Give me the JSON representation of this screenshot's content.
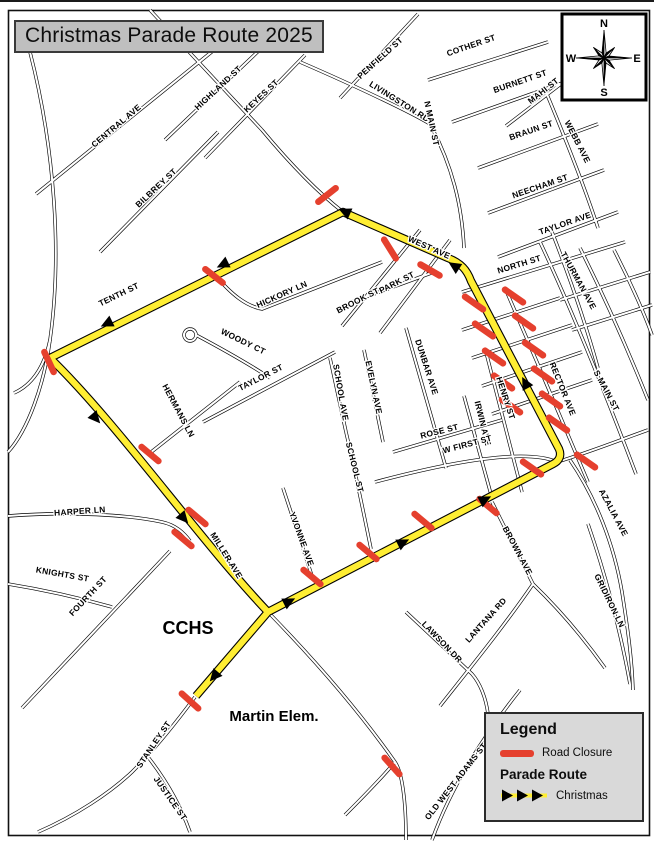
{
  "title": "Christmas Parade Route 2025",
  "compass": {
    "n": "N",
    "e": "E",
    "s": "S",
    "w": "W"
  },
  "legend": {
    "heading": "Legend",
    "road_closure_label": "Road Closure",
    "parade_route_heading": "Parade Route",
    "christmas_label": "Christmas"
  },
  "colors": {
    "route_yellow": "#ffee33",
    "closure_red": "#e5402e",
    "road_black": "#000000",
    "legend_bg": "#d9d9d9",
    "title_bg": "#bfbfbf"
  },
  "places": [
    {
      "label": "CCHS",
      "x": 188,
      "y": 634,
      "s": 18
    },
    {
      "label": "Martin Elem.",
      "x": 274,
      "y": 721,
      "s": 15
    }
  ],
  "streets": [
    {
      "name": "CENTRAL AVE",
      "x": 118,
      "y": 128,
      "r": -40
    },
    {
      "name": "HIGHLAND ST",
      "x": 220,
      "y": 90,
      "r": -43
    },
    {
      "name": "KEYES ST",
      "x": 263,
      "y": 98,
      "r": -43
    },
    {
      "name": "BILBREY ST",
      "x": 158,
      "y": 190,
      "r": -43
    },
    {
      "name": "PENFIELD ST",
      "x": 382,
      "y": 60,
      "r": -42
    },
    {
      "name": "LIVINGSTON RD",
      "x": 398,
      "y": 104,
      "r": 32
    },
    {
      "name": "COTHER ST",
      "x": 472,
      "y": 48,
      "r": -19
    },
    {
      "name": "BURNETT ST",
      "x": 521,
      "y": 84,
      "r": -19
    },
    {
      "name": "N MAIN ST",
      "x": 429,
      "y": 124,
      "r": 78
    },
    {
      "name": "MAHI ST",
      "x": 545,
      "y": 93,
      "r": -38
    },
    {
      "name": "BRAUN ST",
      "x": 532,
      "y": 133,
      "r": -19
    },
    {
      "name": "WEBB AVE",
      "x": 575,
      "y": 143,
      "r": 63
    },
    {
      "name": "NEECHAM ST",
      "x": 541,
      "y": 189,
      "r": -19
    },
    {
      "name": "TAYLOR AVE",
      "x": 566,
      "y": 226,
      "r": -19
    },
    {
      "name": "NORTH ST",
      "x": 520,
      "y": 267,
      "r": -17
    },
    {
      "name": "THURMAN AVE",
      "x": 576,
      "y": 282,
      "r": 61
    },
    {
      "name": "WEST AVE",
      "x": 428,
      "y": 250,
      "r": 24
    },
    {
      "name": "TENTH ST",
      "x": 120,
      "y": 297,
      "r": -26
    },
    {
      "name": "HICKORY LN",
      "x": 283,
      "y": 297,
      "r": -24
    },
    {
      "name": "PARK ST",
      "x": 398,
      "y": 285,
      "r": -27
    },
    {
      "name": "BROOK ST",
      "x": 359,
      "y": 303,
      "r": -27
    },
    {
      "name": "WOODY CT",
      "x": 242,
      "y": 344,
      "r": 26
    },
    {
      "name": "TAYLOR ST",
      "x": 262,
      "y": 380,
      "r": -27
    },
    {
      "name": "SCHOOL AVE",
      "x": 338,
      "y": 393,
      "r": 80
    },
    {
      "name": "EVELYN AVE",
      "x": 371,
      "y": 388,
      "r": 78
    },
    {
      "name": "DUNBAR AVE",
      "x": 424,
      "y": 368,
      "r": 72
    },
    {
      "name": "RECTOR AVE",
      "x": 560,
      "y": 390,
      "r": 68
    },
    {
      "name": "S MAIN ST",
      "x": 604,
      "y": 392,
      "r": 62
    },
    {
      "name": "HERMANS LN",
      "x": 176,
      "y": 412,
      "r": 62
    },
    {
      "name": "HENRY ST",
      "x": 503,
      "y": 399,
      "r": 72
    },
    {
      "name": "IRWIN AVE",
      "x": 480,
      "y": 424,
      "r": 76
    },
    {
      "name": "ROSE ST",
      "x": 440,
      "y": 434,
      "r": -14
    },
    {
      "name": "SCHOOL ST",
      "x": 352,
      "y": 468,
      "r": 76
    },
    {
      "name": "W FIRST ST",
      "x": 468,
      "y": 447,
      "r": -15
    },
    {
      "name": "HARPER LN",
      "x": 80,
      "y": 514,
      "r": -4
    },
    {
      "name": "KNIGHTS ST",
      "x": 62,
      "y": 577,
      "r": 10
    },
    {
      "name": "FOURTH ST",
      "x": 90,
      "y": 598,
      "r": -47
    },
    {
      "name": "MILLER AVE",
      "x": 224,
      "y": 557,
      "r": 58
    },
    {
      "name": "YVONNE AVE",
      "x": 299,
      "y": 540,
      "r": 70
    },
    {
      "name": "STANLEY ST",
      "x": 156,
      "y": 746,
      "r": -56
    },
    {
      "name": "JUSTICE ST",
      "x": 168,
      "y": 800,
      "r": 55
    },
    {
      "name": "LAWSON DR",
      "x": 440,
      "y": 644,
      "r": 46
    },
    {
      "name": "LANTANA RD",
      "x": 488,
      "y": 622,
      "r": -48
    },
    {
      "name": "BROWN AVE",
      "x": 515,
      "y": 552,
      "r": 62
    },
    {
      "name": "AZALIA AVE",
      "x": 611,
      "y": 514,
      "r": 62
    },
    {
      "name": "GRIDIRON LN",
      "x": 607,
      "y": 602,
      "r": 64
    },
    {
      "name": "OLD WEST ADAMS ST",
      "x": 458,
      "y": 783,
      "r": -52
    }
  ],
  "map": {
    "frame": {
      "x": 8,
      "y": 10,
      "w": 641,
      "h": 825
    },
    "roads": [
      "M 30 52 C 55 150 62 255 50 340 C 44 385 28 430 8 452",
      "M 50 340 C 44 368 32 385 14 393",
      "M 36 194 L 214 50",
      "M 150 10 L 262 130",
      "M 262 130 C 292 166 320 194 343 212",
      "M 165 140 L 268 42",
      "M 205 158 L 305 55",
      "M 100 252 L 218 132",
      "M 340 98 L 418 14",
      "M 300 62 C 360 88 412 113 430 124 C 452 165 462 205 464 248",
      "M 214 274 C 232 295 246 306 262 309 L 382 262",
      "M 190 329 a 6 6 0 1 0 0.1 0",
      "M 196 335 C 226 351 252 366 270 378",
      "M 342 326 L 420 230",
      "M 380 333 L 450 240",
      "M 352 302 L 434 272",
      "M 203 422 L 335 352",
      "M 330 358 L 346 432",
      "M 364 350 L 383 442",
      "M 406 328 L 446 468",
      "M 346 432 C 356 475 364 515 371 549",
      "M 283 488 L 313 579",
      "M 150 453 L 240 382",
      "M 8 516 C 70 511 130 515 162 522 C 176 525 184 533 190 541",
      "M 22 708 L 170 551",
      "M 8 584 C 45 590 80 598 112 607",
      "M 195 697 C 172 728 152 752 132 772 C 110 793 75 816 38 832",
      "M 148 757 C 166 780 180 804 190 832",
      "M 268 612 C 305 650 355 705 395 762 C 402 772 406 800 406 840",
      "M 395 762 C 380 780 360 800 345 815",
      "M 520 690 C 480 740 450 790 432 840",
      "M 406 612 L 472 674 C 480 683 486 698 488 714",
      "M 492 502 L 533 584",
      "M 533 584 C 505 625 470 668 440 706",
      "M 533 584 C 560 610 585 640 605 668",
      "M 570 460 C 596 498 614 545 622 592 C 628 630 632 660 633 690",
      "M 588 524 C 604 570 620 628 630 684",
      "M 393 452 L 502 420",
      "M 375 482 C 450 462 525 448 557 462 C 590 452 620 440 648 430",
      "M 462 330 L 560 298",
      "M 472 358 L 572 325",
      "M 482 386 L 582 352",
      "M 492 414 L 592 380",
      "M 462 292 L 625 242",
      "M 498 257 L 618 212",
      "M 488 213 L 604 170",
      "M 478 168 L 598 124",
      "M 452 122 L 582 76",
      "M 428 80 L 548 42",
      "M 506 126 L 566 80",
      "M 546 92 C 566 140 584 185 598 228",
      "M 552 232 C 570 278 586 325 598 368",
      "M 505 288 C 532 350 562 420 588 482",
      "M 540 242 C 572 310 606 395 636 474",
      "M 580 248 C 606 300 630 355 648 400",
      "M 614 250 C 632 285 646 318 652 335",
      "M 560 300 L 650 272",
      "M 572 330 L 652 305",
      "M 486 352 L 522 492",
      "M 464 396 L 492 498"
    ],
    "route": [
      "M 50 358 L 343 212 L 448 258 C 461 263 467 270 471 281 L 559 449 C 562 456 559 461 553 464 L 268 612 L 196 696",
      "M 50 358 C 118 424 198 538 268 612"
    ],
    "arrows": [
      {
        "x": 228,
        "y": 262,
        "r": 154
      },
      {
        "x": 112,
        "y": 321,
        "r": 154
      },
      {
        "x": 350,
        "y": 214,
        "r": 204
      },
      {
        "x": 459,
        "y": 269,
        "r": 213
      },
      {
        "x": 528,
        "y": 388,
        "r": 242
      },
      {
        "x": 480,
        "y": 502,
        "r": -27
      },
      {
        "x": 398,
        "y": 545,
        "r": -27
      },
      {
        "x": 284,
        "y": 604,
        "r": -27
      },
      {
        "x": 92,
        "y": 414,
        "r": 49
      },
      {
        "x": 180,
        "y": 514,
        "r": 49
      },
      {
        "x": 218,
        "y": 672,
        "r": 131
      }
    ],
    "closures": [
      {
        "x": 327,
        "y": 195,
        "r": -38
      },
      {
        "x": 390,
        "y": 249,
        "r": 58
      },
      {
        "x": 430,
        "y": 270,
        "r": 30
      },
      {
        "x": 214,
        "y": 276,
        "r": 38
      },
      {
        "x": 49,
        "y": 362,
        "r": 65
      },
      {
        "x": 150,
        "y": 454,
        "r": 40
      },
      {
        "x": 197,
        "y": 517,
        "r": 40
      },
      {
        "x": 183,
        "y": 539,
        "r": 40
      },
      {
        "x": 312,
        "y": 577,
        "r": 40
      },
      {
        "x": 368,
        "y": 552,
        "r": 40
      },
      {
        "x": 423,
        "y": 521,
        "r": 40
      },
      {
        "x": 488,
        "y": 506,
        "r": 40
      },
      {
        "x": 190,
        "y": 701,
        "r": 42
      },
      {
        "x": 392,
        "y": 766,
        "r": 48
      },
      {
        "x": 474,
        "y": 303,
        "r": 35
      },
      {
        "x": 484,
        "y": 330,
        "r": 35
      },
      {
        "x": 494,
        "y": 357,
        "r": 35
      },
      {
        "x": 503,
        "y": 382,
        "r": 35
      },
      {
        "x": 511,
        "y": 406,
        "r": 35
      },
      {
        "x": 514,
        "y": 296,
        "r": 35
      },
      {
        "x": 524,
        "y": 322,
        "r": 35
      },
      {
        "x": 534,
        "y": 349,
        "r": 35
      },
      {
        "x": 543,
        "y": 375,
        "r": 35
      },
      {
        "x": 551,
        "y": 400,
        "r": 35
      },
      {
        "x": 558,
        "y": 424,
        "r": 35
      },
      {
        "x": 586,
        "y": 461,
        "r": 35
      },
      {
        "x": 532,
        "y": 468,
        "r": 35
      }
    ],
    "compass": {
      "box": {
        "x": 562,
        "y": 14,
        "w": 84,
        "h": 86
      },
      "cx": 604,
      "cy": 58
    }
  }
}
